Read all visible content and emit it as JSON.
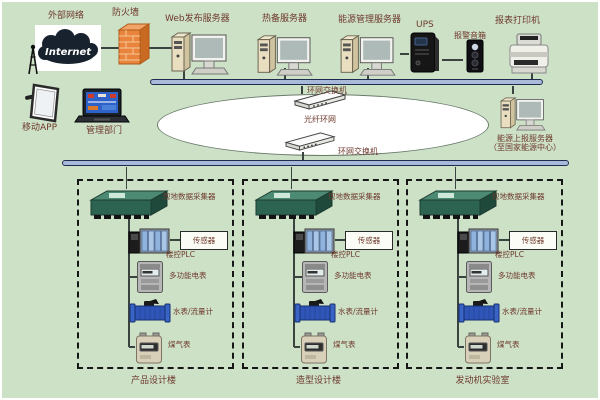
{
  "diagram": {
    "top_row": {
      "external_network": {
        "label": "外部网络",
        "cloud_text": "Internet"
      },
      "firewall": {
        "label": "防火墙"
      },
      "web_server": {
        "label": "Web发布服务器"
      },
      "hot_standby_server": {
        "label": "热备服务器"
      },
      "energy_mgmt_server": {
        "label": "能源管理服务器"
      },
      "ups": {
        "label": "UPS"
      },
      "alarm_speaker": {
        "label": "报警音箱"
      },
      "report_printer": {
        "label": "报表打印机"
      }
    },
    "left_side": {
      "mobile_app": {
        "label": "移动APP"
      },
      "mgmt_dept": {
        "label": "管理部门"
      }
    },
    "ring_network": {
      "switch_top": "环网交换机",
      "fiber_ring": "光纤环网",
      "switch_bottom": "环网交换机"
    },
    "report_server": {
      "name": "能源上报服务器",
      "dest": "（至国家能源中心）"
    },
    "buildings": [
      {
        "name": "产品设计楼",
        "collector": "现地数据采集器",
        "sensor": "传感器",
        "plc": "楼控PLC",
        "power_meter": "多功能电表",
        "water_meter": "水表/流量计",
        "gas_meter": "煤气表"
      },
      {
        "name": "造型设计楼",
        "collector": "现地数据采集器",
        "sensor": "传感器",
        "plc": "楼控PLC",
        "power_meter": "多功能电表",
        "water_meter": "水表/流量计",
        "gas_meter": "煤气表"
      },
      {
        "name": "发动机实验室",
        "collector": "现地数据采集器",
        "sensor": "传感器",
        "plc": "楼控PLC",
        "power_meter": "多功能电表",
        "water_meter": "水表/流量计",
        "gas_meter": "煤气表"
      }
    ],
    "colors": {
      "background": "#cde1c7",
      "bus_fill": "#a9b9da",
      "bus_border": "#1d2c4e",
      "label_text": "#6e392c",
      "ring_fill": "#ffffff",
      "firewall_orange": "#e8843c",
      "collector_green": "#2c6351",
      "plc_slat_blue": "#8fb3dd",
      "water_meter_blue": "#2f55b8",
      "gas_meter_beige": "#d9d0ba"
    }
  }
}
